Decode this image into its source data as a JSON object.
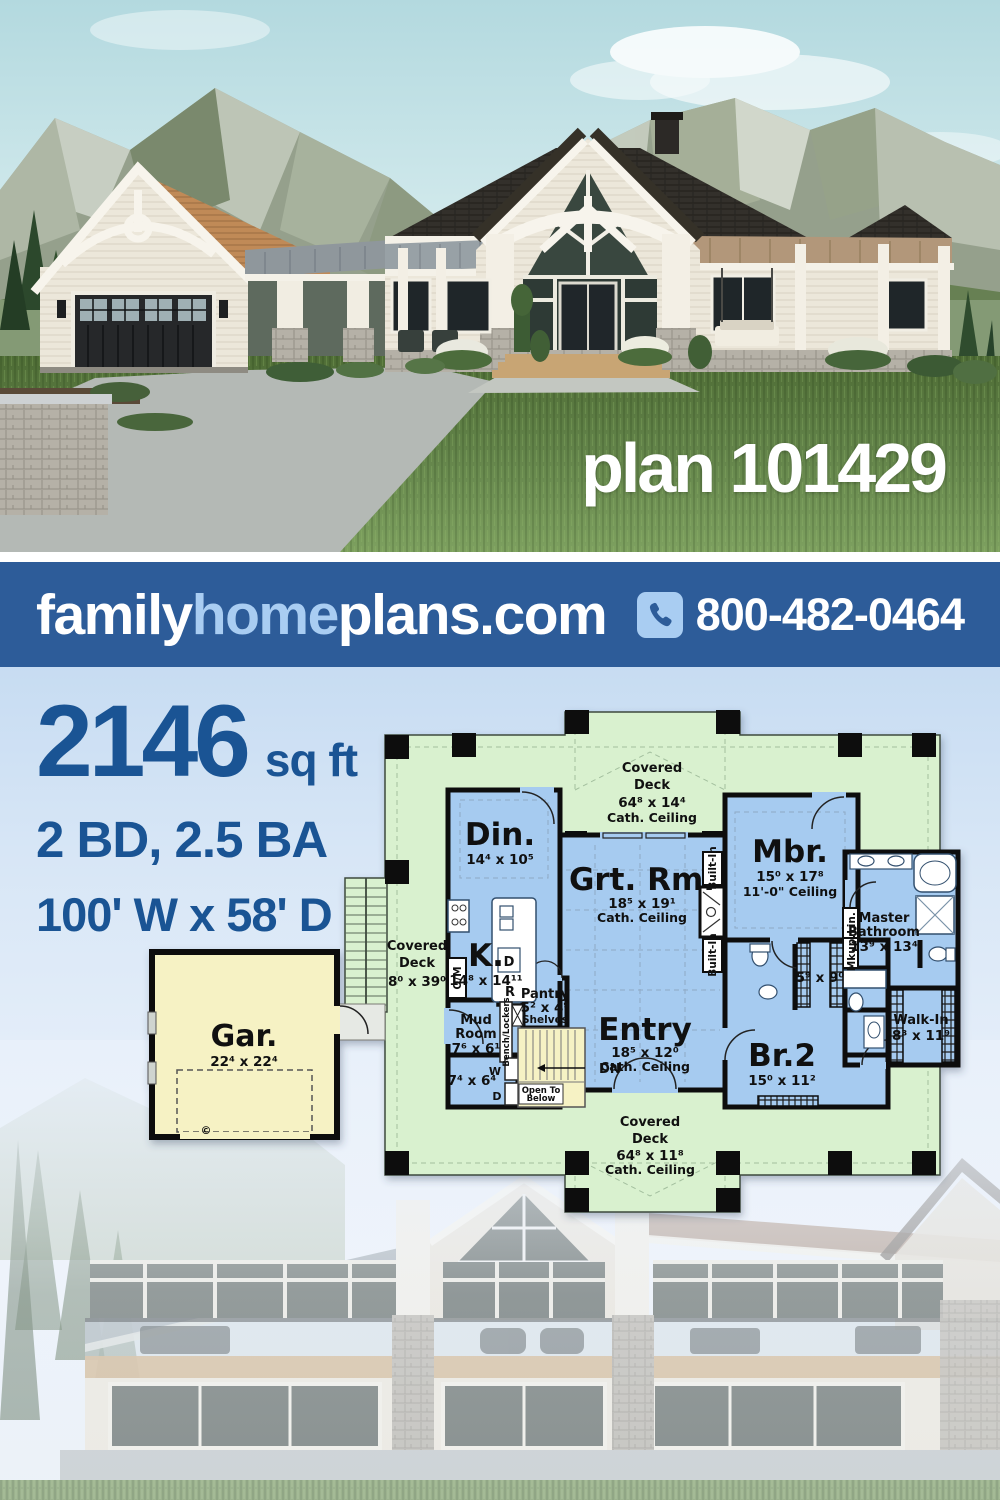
{
  "hero": {
    "plan_label": "plan 101429"
  },
  "banner": {
    "brand": {
      "part1": "family",
      "part2": "home",
      "part3": "plans.com"
    },
    "phone": "800-482-0464"
  },
  "stats": {
    "sqft": "2146",
    "sqft_unit": "sq ft",
    "bed_bath": "2 BD, 2.5 BA",
    "footprint": "100' W x 58' D"
  },
  "floorplan": {
    "deck_top": {
      "w1": "Covered",
      "w2": "Deck",
      "dims": "64⁸ x 14⁴",
      "ceil": "Cath. Ceiling"
    },
    "deck_left": {
      "w1": "Covered",
      "w2": "Deck",
      "dims": "8⁰ x 39⁰"
    },
    "deck_bottom": {
      "w1": "Covered",
      "w2": "Deck",
      "dims": "64⁸ x 11⁸",
      "ceil": "Cath. Ceiling"
    },
    "dining": {
      "name": "Din.",
      "dims": "14⁴ x 10⁵"
    },
    "great": {
      "name": "Grt. Rm.",
      "dims": "18⁵ x 19¹",
      "ceil": "Cath. Ceiling"
    },
    "master": {
      "name": "Mbr.",
      "dims": "15⁰ x 17⁸",
      "ceil": "11'-0\" Ceiling"
    },
    "kitchen": {
      "name": "K.",
      "dims": "14⁸ x 14¹¹"
    },
    "entry": {
      "name": "Entry",
      "dims": "18⁵ x 12⁰",
      "ceil": "Cath. Ceiling"
    },
    "bed2": {
      "name": "Br.2",
      "dims": "15⁰ x 11²"
    },
    "mbath": {
      "w1": "Master",
      "w2": "Bathroom",
      "dims": "13⁹ x 13⁴"
    },
    "walkin": {
      "name": "Walk-In",
      "dims": "8³ x 11⁹"
    },
    "mud": {
      "w1": "Mud",
      "w2": "Room",
      "dims": "7⁶ x 6¹"
    },
    "laundry": {
      "dims": "7⁴ x 6⁴",
      "washer": "W",
      "dryer": "D"
    },
    "pantry": {
      "name": "Pantry",
      "dims": "5² x 4⁹",
      "note": "Shelves"
    },
    "hall": {
      "dims": "5⁹ x 9⁰"
    },
    "garage": {
      "name": "Gar.",
      "dims": "22⁴ x 22⁴",
      "copyright": "©"
    },
    "built_in_top": "Built-In",
    "built_in_bottom": "Built-In",
    "open_below_1": "Open To",
    "open_below_2": "Below",
    "dn": "DN",
    "bench": "Bench/Lockers",
    "om": "O/M",
    "fridge": "R",
    "dishwasher": "D",
    "makeup": "Mkup.",
    "linen": "Lin."
  },
  "colors": {
    "banner_bg": "#2d5c99",
    "banner_accent": "#a9cdf2",
    "stats_text": "#1a5494",
    "deck_green": "#d9f1cf",
    "room_blue": "#a6cbf0",
    "garage_yellow": "#f6f2c4",
    "wall_black": "#0d0d0d"
  }
}
